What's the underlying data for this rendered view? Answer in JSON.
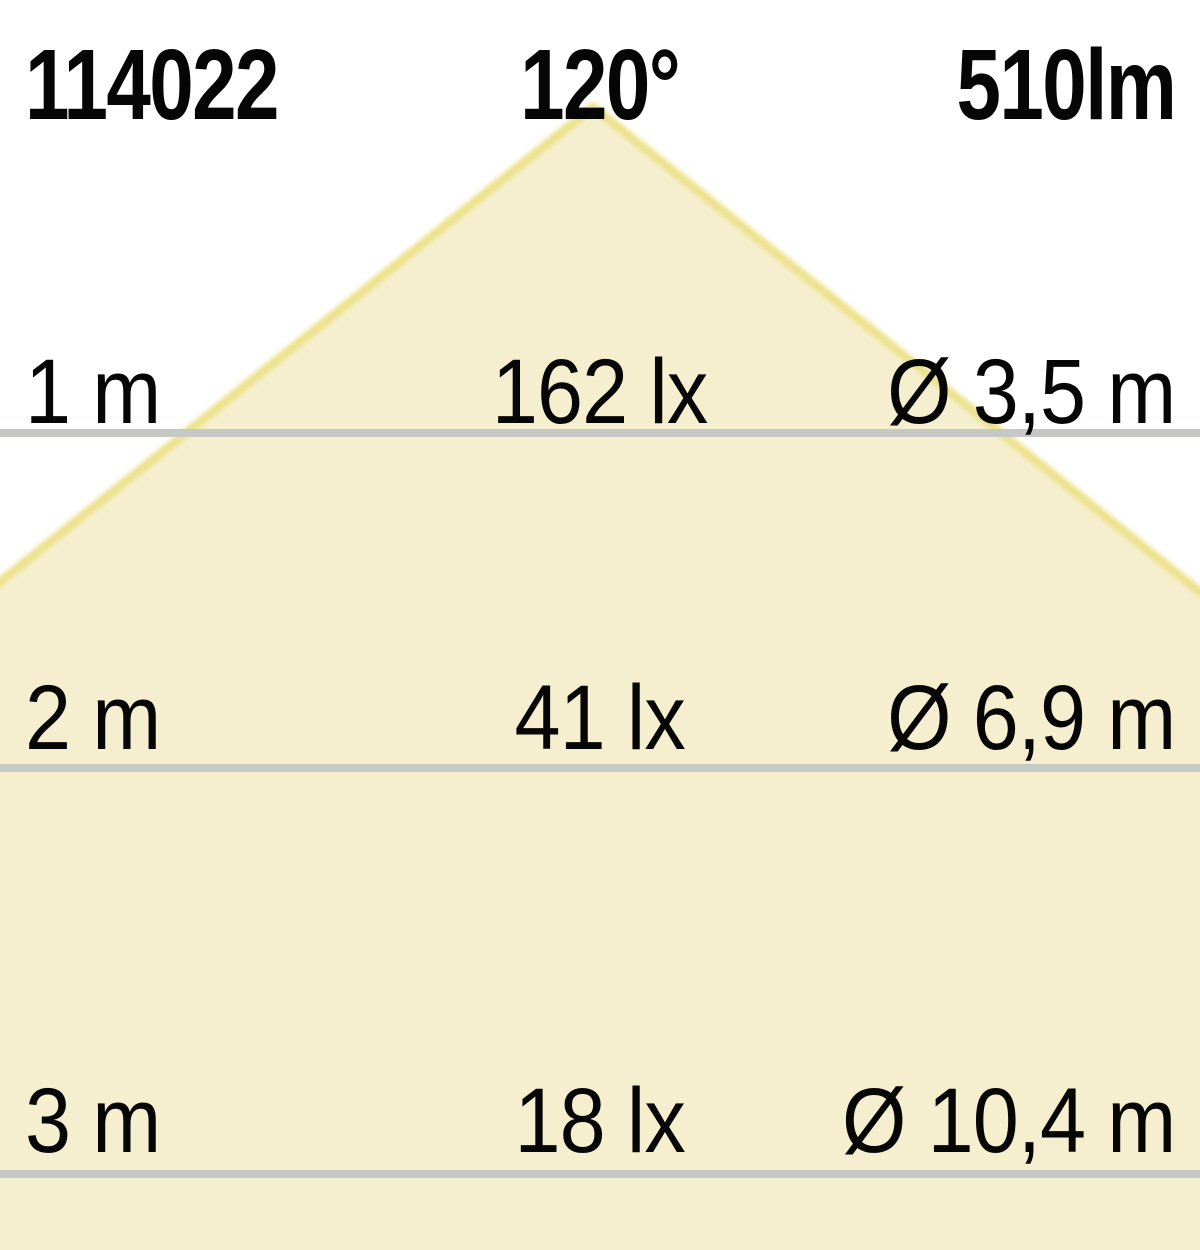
{
  "header": {
    "article_number": "114022",
    "beam_angle": "120°",
    "luminous_flux": "510lm"
  },
  "rows": [
    {
      "distance": "1 m",
      "illuminance": "162 lx",
      "diameter": "Ø 3,5 m"
    },
    {
      "distance": "2 m",
      "illuminance": "41 lx",
      "diameter": "Ø 6,9 m"
    },
    {
      "distance": "3 m",
      "illuminance": "18 lx",
      "diameter": "Ø 10,4 m"
    }
  ],
  "colors": {
    "background": "#ffffff",
    "cone_fill": "#f6efcf",
    "cone_edge": "#ece189",
    "line": "#c4c9c6",
    "text": "#060606"
  },
  "chart_data": {
    "type": "table",
    "title": "LED light cone diagram",
    "article_number": "114022",
    "beam_angle_deg": 120,
    "luminous_flux_lm": 510,
    "columns": [
      "distance_m",
      "illuminance_lx",
      "light_circle_diameter_m"
    ],
    "rows_numeric": [
      {
        "distance_m": 1,
        "illuminance_lx": 162,
        "light_circle_diameter_m": 3.5
      },
      {
        "distance_m": 2,
        "illuminance_lx": 41,
        "light_circle_diameter_m": 6.9
      },
      {
        "distance_m": 3,
        "illuminance_lx": 18,
        "light_circle_diameter_m": 10.4
      }
    ],
    "layout_hints": {
      "cone_apex_px": [
        593,
        107
      ],
      "distance_line_y_px": [
        429,
        764,
        1170
      ],
      "grid": "horizontal lines at each distance",
      "legend": "none"
    }
  }
}
